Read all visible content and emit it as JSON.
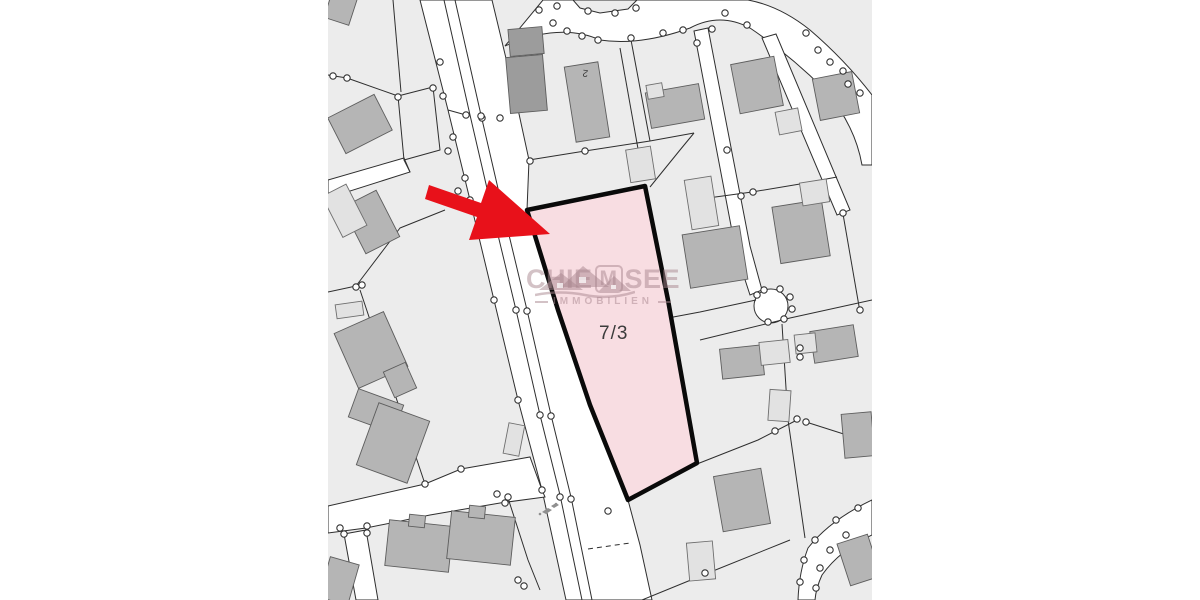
{
  "map": {
    "parcel_label": "7/3",
    "house_number_label": "2",
    "watermark": {
      "brand_prefix": "CHIE",
      "brand_boxed": "M",
      "brand_suffix": "SEE",
      "subtitle": "IMMOBILIEN"
    },
    "colors": {
      "background": "#ffffff",
      "parcel_area": "#ececec",
      "road_fill": "#ffffff",
      "boundary_line": "#2e2e2e",
      "building_fill": "#b5b5b5",
      "building_dark": "#9c9c9c",
      "building_light": "#e2e2e2",
      "survey_point_fill": "#ffffff",
      "highlight_fill": "#f8dde2",
      "highlight_border": "#0a0a0a",
      "arrow_red": "#e8111a",
      "watermark_color": "#a8868e",
      "label_color": "#3b3b3b"
    }
  }
}
